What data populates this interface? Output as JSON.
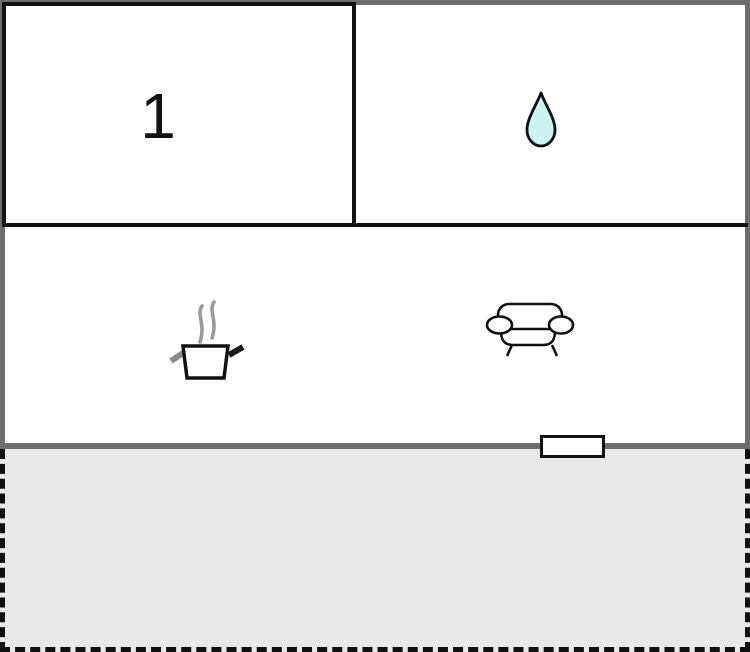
{
  "floorplan": {
    "room1": {
      "label": "1"
    },
    "bathroom": {
      "icon": "water-drop-icon"
    },
    "living_area": {
      "icons": [
        "cooking-pot-icon",
        "sofa-icon"
      ]
    },
    "terrace": {
      "style": "dashed-outline"
    },
    "door": {
      "style": "white-rect"
    },
    "colors": {
      "wall_black": "#121212",
      "wall_gray": "#6d6d6d",
      "terrace_fill": "#e9e9e9",
      "water_drop_fill": "#cdf4f4",
      "steam_gray": "#9a9a9a",
      "background": "#ffffff"
    }
  }
}
